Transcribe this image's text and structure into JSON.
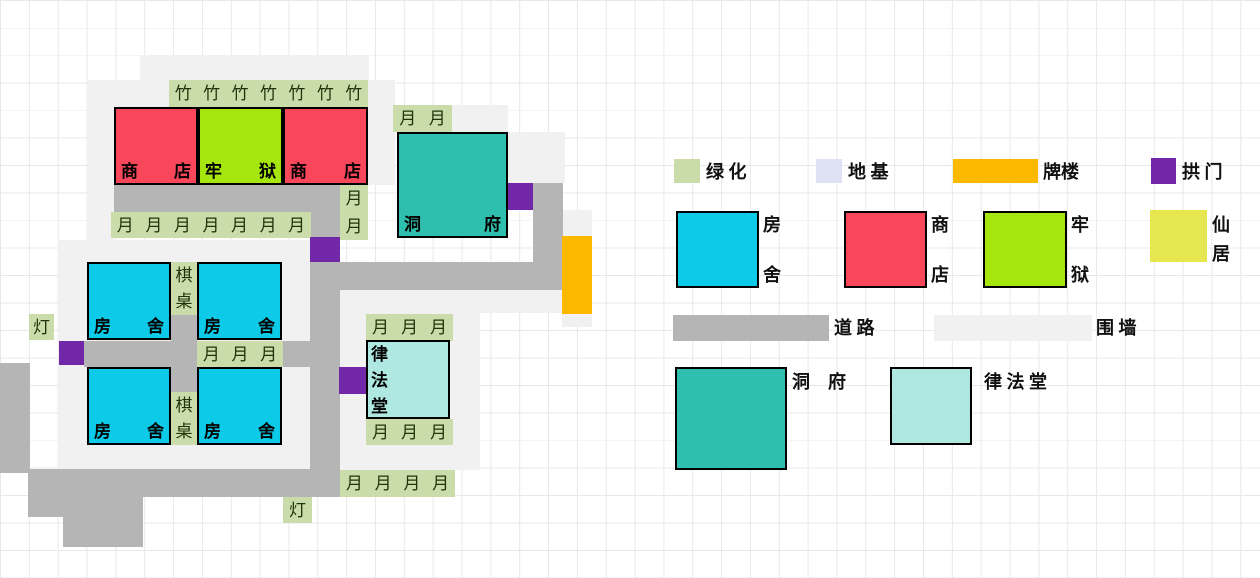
{
  "palette": {
    "shop": "#f8465a",
    "prison": "#a5e60e",
    "house": "#0ccae8",
    "dongfu": "#2fbfae",
    "lvfatang": "#aee8e1",
    "xianju": "#e6e650",
    "archway": "#fdb900",
    "arch": "#7127a8",
    "greenery": "#cbdcab",
    "foundation": "#dee2f4",
    "road": "#b5b5b5",
    "wall": "#f1f1f1",
    "tile_char": "#1e3309",
    "grid_line": "#e8e8e8",
    "border": "#000000"
  },
  "map": {
    "walls": [
      [
        140,
        55,
        229,
        25
      ],
      [
        88,
        80,
        26,
        160
      ],
      [
        114,
        80,
        55,
        27
      ],
      [
        368,
        80,
        27,
        105
      ],
      [
        452,
        105,
        56,
        27
      ],
      [
        508,
        132,
        57,
        51
      ],
      [
        563,
        210,
        29,
        26
      ],
      [
        340,
        290,
        223,
        23
      ],
      [
        340,
        313,
        140,
        157
      ],
      [
        59,
        240,
        251,
        230
      ],
      [
        562,
        314,
        30,
        13
      ]
    ],
    "roads": [
      [
        114,
        185,
        226,
        27
      ],
      [
        310,
        212,
        30,
        285
      ],
      [
        340,
        262,
        193,
        28
      ],
      [
        533,
        183,
        30,
        107
      ],
      [
        84,
        341,
        113,
        26
      ],
      [
        171,
        315,
        26,
        26
      ],
      [
        171,
        367,
        26,
        25
      ],
      [
        283,
        341,
        27,
        26
      ],
      [
        28,
        469,
        312,
        28
      ],
      [
        28,
        497,
        115,
        20
      ],
      [
        63,
        517,
        80,
        30
      ],
      [
        0,
        363,
        30,
        110
      ]
    ],
    "greens": [
      {
        "x": 169,
        "y": 80,
        "w": 199,
        "h": 27,
        "dir": "h",
        "chars": [
          "竹",
          "竹",
          "竹",
          "竹",
          "竹",
          "竹",
          "竹"
        ]
      },
      {
        "x": 111,
        "y": 212,
        "w": 200,
        "h": 26,
        "dir": "h",
        "chars": [
          "月",
          "月",
          "月",
          "月",
          "月",
          "月",
          "月"
        ]
      },
      {
        "x": 340,
        "y": 185,
        "w": 28,
        "h": 55,
        "dir": "v",
        "chars": [
          "月",
          "月"
        ]
      },
      {
        "x": 393,
        "y": 105,
        "w": 59,
        "h": 27,
        "dir": "h",
        "chars": [
          "月",
          "月"
        ]
      },
      {
        "x": 171,
        "y": 262,
        "w": 26,
        "h": 53,
        "dir": "v",
        "chars": [
          "棋",
          "桌"
        ]
      },
      {
        "x": 171,
        "y": 392,
        "w": 26,
        "h": 53,
        "dir": "v",
        "chars": [
          "棋",
          "桌"
        ]
      },
      {
        "x": 197,
        "y": 341,
        "w": 86,
        "h": 26,
        "dir": "h",
        "chars": [
          "月",
          "月",
          "月"
        ]
      },
      {
        "x": 366,
        "y": 314,
        "w": 87,
        "h": 27,
        "dir": "h",
        "chars": [
          "月",
          "月",
          "月"
        ]
      },
      {
        "x": 366,
        "y": 419,
        "w": 87,
        "h": 26,
        "dir": "h",
        "chars": [
          "月",
          "月",
          "月"
        ]
      },
      {
        "x": 340,
        "y": 470,
        "w": 115,
        "h": 27,
        "dir": "h",
        "chars": [
          "月",
          "月",
          "月",
          "月"
        ]
      }
    ],
    "lamps": [
      {
        "x": 29,
        "y": 314,
        "w": 25,
        "h": 26,
        "char": "灯"
      },
      {
        "x": 283,
        "y": 497,
        "w": 29,
        "h": 26,
        "char": "灯"
      }
    ],
    "arches": [
      [
        310,
        237,
        30,
        25
      ],
      [
        59,
        341,
        25,
        24
      ],
      [
        339,
        367,
        27,
        27
      ],
      [
        507,
        183,
        26,
        27
      ]
    ],
    "gateways": [
      [
        562,
        236,
        30,
        78
      ]
    ],
    "buildings": [
      {
        "type": "shop",
        "x": 114,
        "y": 107,
        "w": 84,
        "h": 78,
        "color": "shop",
        "labels": [
          "商",
          "店"
        ],
        "mode": "corners"
      },
      {
        "type": "prison",
        "x": 198,
        "y": 107,
        "w": 85,
        "h": 78,
        "color": "prison",
        "labels": [
          "牢",
          "狱"
        ],
        "mode": "corners"
      },
      {
        "type": "shop",
        "x": 283,
        "y": 107,
        "w": 85,
        "h": 78,
        "color": "shop",
        "labels": [
          "商",
          "店"
        ],
        "mode": "corners"
      },
      {
        "type": "dongfu",
        "x": 397,
        "y": 132,
        "w": 111,
        "h": 106,
        "color": "dongfu",
        "labels": [
          "洞",
          "府"
        ],
        "mode": "corners"
      },
      {
        "type": "house",
        "x": 87,
        "y": 262,
        "w": 84,
        "h": 78,
        "color": "house",
        "labels": [
          "房",
          "舍"
        ],
        "mode": "corners"
      },
      {
        "type": "house",
        "x": 197,
        "y": 262,
        "w": 85,
        "h": 78,
        "color": "house",
        "labels": [
          "房",
          "舍"
        ],
        "mode": "corners"
      },
      {
        "type": "house",
        "x": 87,
        "y": 367,
        "w": 84,
        "h": 78,
        "color": "house",
        "labels": [
          "房",
          "舍"
        ],
        "mode": "corners"
      },
      {
        "type": "house",
        "x": 197,
        "y": 367,
        "w": 85,
        "h": 78,
        "color": "house",
        "labels": [
          "房",
          "舍"
        ],
        "mode": "corners"
      },
      {
        "type": "lvfatang",
        "x": 366,
        "y": 340,
        "w": 84,
        "h": 79,
        "color": "lvfatang",
        "labels": [
          "律",
          "法",
          "堂"
        ],
        "mode": "vleft"
      }
    ]
  },
  "legend": {
    "items": [
      {
        "id": "greenery",
        "kind": "tile",
        "swatch": {
          "x": 674,
          "y": 159,
          "w": 26,
          "h": 24,
          "color": "greenery",
          "border": false
        },
        "label": {
          "text": "绿 化",
          "x": 706,
          "y": 162
        }
      },
      {
        "id": "foundation",
        "kind": "tile",
        "swatch": {
          "x": 816,
          "y": 159,
          "w": 26,
          "h": 24,
          "color": "foundation",
          "border": false
        },
        "label": {
          "text": "地 基",
          "x": 848,
          "y": 162
        }
      },
      {
        "id": "paifang",
        "kind": "bar",
        "swatch": {
          "x": 953,
          "y": 159,
          "w": 85,
          "h": 24,
          "color": "archway",
          "border": false
        },
        "label": {
          "text": "牌楼",
          "x": 1043,
          "y": 162
        }
      },
      {
        "id": "arch",
        "kind": "tile",
        "swatch": {
          "x": 1151,
          "y": 158,
          "w": 25,
          "h": 26,
          "color": "arch",
          "border": false
        },
        "label": {
          "text": "拱 门",
          "x": 1182,
          "y": 162
        }
      },
      {
        "id": "house",
        "kind": "square",
        "swatch": {
          "x": 676,
          "y": 211,
          "w": 83,
          "h": 77,
          "color": "house",
          "border": true
        },
        "vlabel": {
          "chars": [
            "房",
            "舍"
          ],
          "x": 763,
          "y": 216,
          "gap": 50
        }
      },
      {
        "id": "shop",
        "kind": "square",
        "swatch": {
          "x": 844,
          "y": 211,
          "w": 83,
          "h": 77,
          "color": "shop",
          "border": true
        },
        "vlabel": {
          "chars": [
            "商",
            "店"
          ],
          "x": 931,
          "y": 216,
          "gap": 50
        }
      },
      {
        "id": "prison",
        "kind": "square",
        "swatch": {
          "x": 983,
          "y": 211,
          "w": 84,
          "h": 77,
          "color": "prison",
          "border": true
        },
        "vlabel": {
          "chars": [
            "牢",
            "狱"
          ],
          "x": 1071,
          "y": 216,
          "gap": 50
        }
      },
      {
        "id": "xianju",
        "kind": "square",
        "swatch": {
          "x": 1150,
          "y": 210,
          "w": 57,
          "h": 52,
          "color": "xianju",
          "border": false
        },
        "vlabel": {
          "chars": [
            "仙",
            "居"
          ],
          "x": 1212,
          "y": 216,
          "gap": 29
        }
      },
      {
        "id": "road",
        "kind": "bar",
        "swatch": {
          "x": 673,
          "y": 315,
          "w": 156,
          "h": 26,
          "color": "road",
          "border": false
        },
        "label": {
          "text": "道 路",
          "x": 834,
          "y": 318
        }
      },
      {
        "id": "wall",
        "kind": "bar",
        "swatch": {
          "x": 934,
          "y": 315,
          "w": 158,
          "h": 26,
          "color": "wall",
          "border": false
        },
        "label": {
          "text": "围 墙",
          "x": 1096,
          "y": 318
        }
      },
      {
        "id": "dongfu",
        "kind": "square",
        "swatch": {
          "x": 675,
          "y": 367,
          "w": 112,
          "h": 103,
          "color": "dongfu",
          "border": true
        },
        "label": {
          "text": "洞　府",
          "x": 792,
          "y": 372
        }
      },
      {
        "id": "lvfatang",
        "kind": "square",
        "swatch": {
          "x": 890,
          "y": 367,
          "w": 82,
          "h": 78,
          "color": "lvfatang",
          "border": true
        },
        "label": {
          "text": "律 法 堂",
          "x": 984,
          "y": 372
        }
      }
    ]
  }
}
